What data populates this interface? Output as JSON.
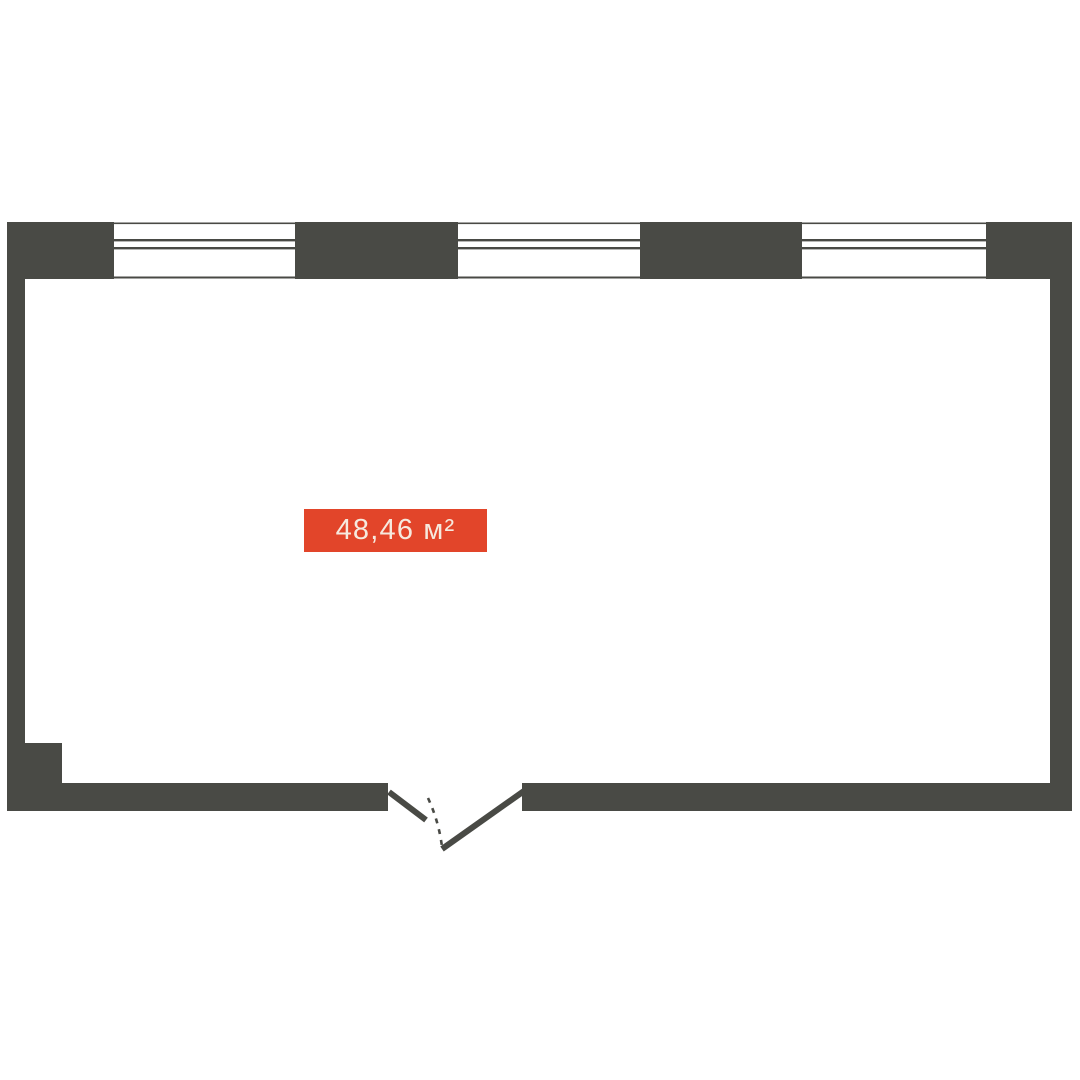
{
  "floor_plan": {
    "area_label": {
      "text": "48,46 м²"
    },
    "colors": {
      "wall": "#494a45",
      "background": "#ffffff",
      "label_bg": "#e2452a",
      "label_text": "#f6e9de"
    },
    "windows_count": 3,
    "door_position": "bottom-center"
  }
}
